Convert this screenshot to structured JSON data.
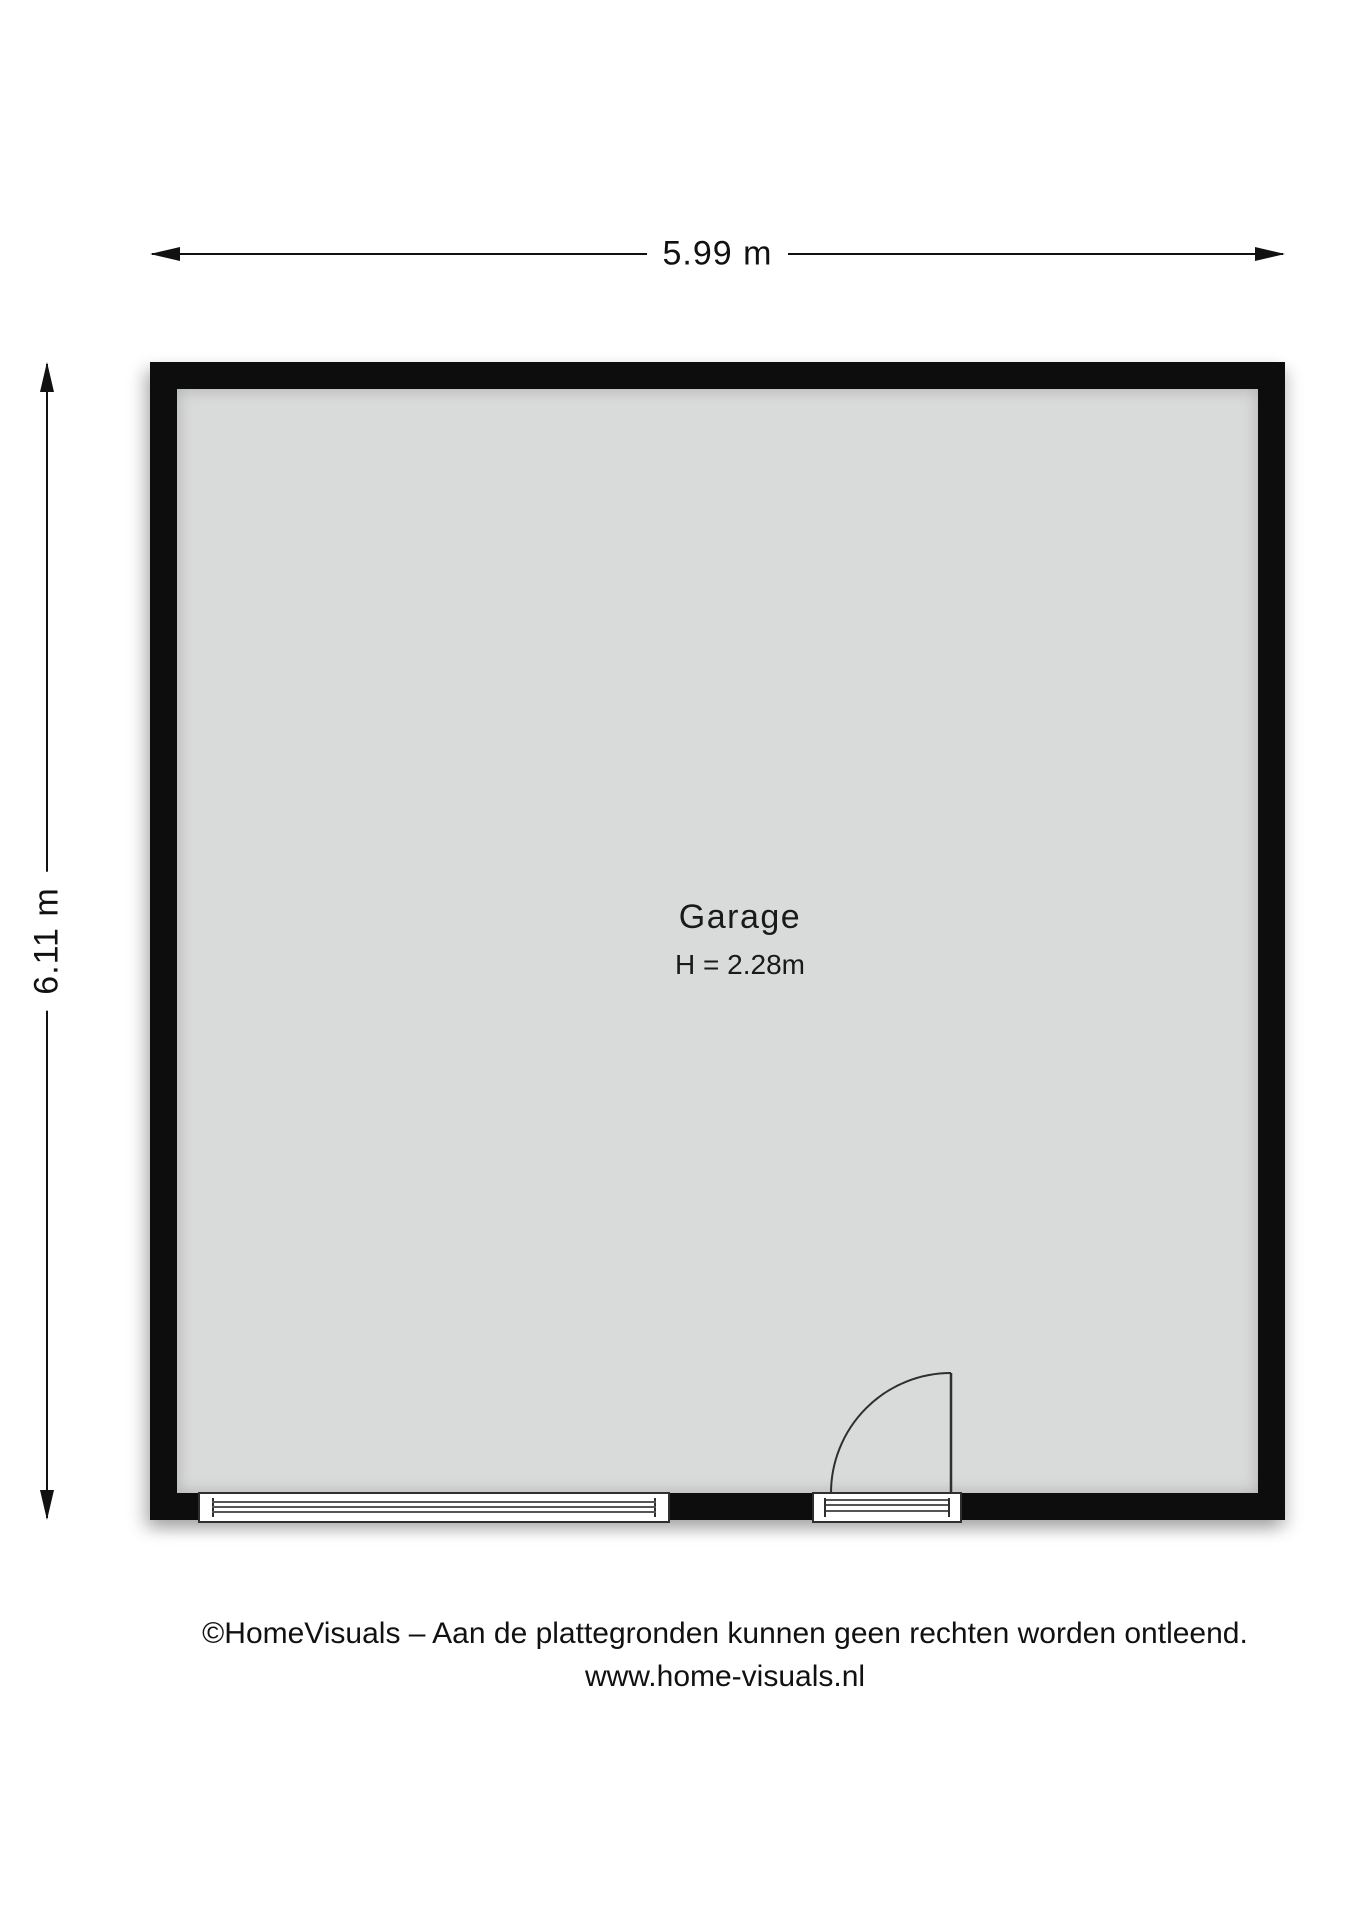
{
  "plan": {
    "dimensions": {
      "width_label": "5.99 m",
      "height_label": "6.11 m"
    },
    "room": {
      "name": "Garage",
      "ceiling_height_label": "H = 2.28m"
    },
    "colors": {
      "wall": "#0d0d0d",
      "floor": "#d9dada",
      "line": "#111111",
      "background": "#ffffff"
    }
  },
  "footer": {
    "line1": "©HomeVisuals – Aan de plattegronden kunnen geen rechten worden ontleend.",
    "line2": "www.home-visuals.nl"
  }
}
